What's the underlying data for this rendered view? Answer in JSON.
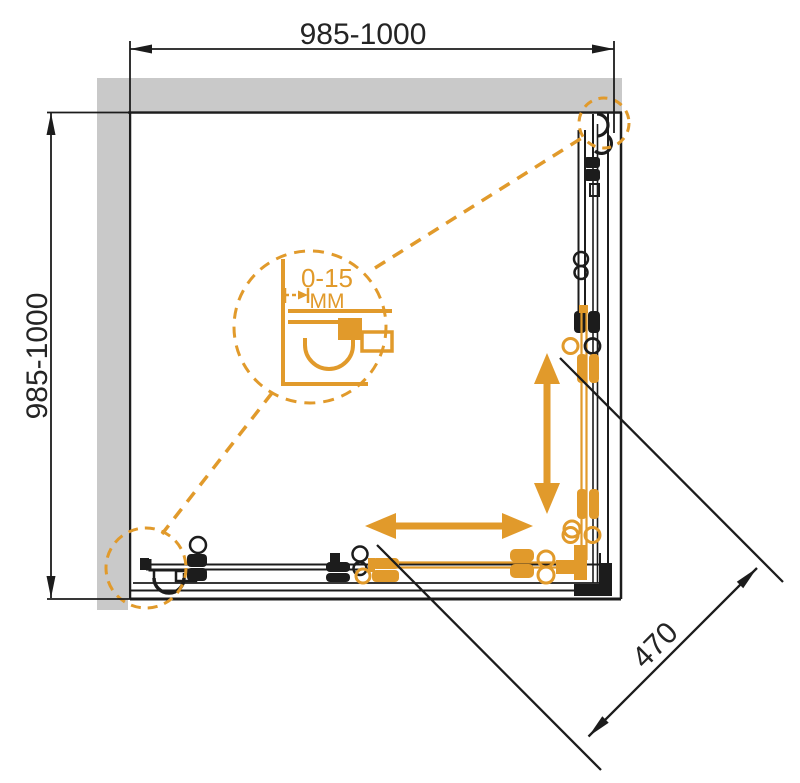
{
  "diagram": {
    "label": "Corner shower enclosure - top view technical drawing",
    "dim_top": "985-1000",
    "dim_left": "985-1000",
    "dim_diagonal": "470",
    "detail": {
      "range": "0-15",
      "unit": "MM"
    },
    "colors": {
      "accent_orange": "#E19A2B",
      "line_black": "#1C1C1C",
      "wall_gray": "#C9C9C9",
      "background": "#FFFFFF"
    }
  }
}
